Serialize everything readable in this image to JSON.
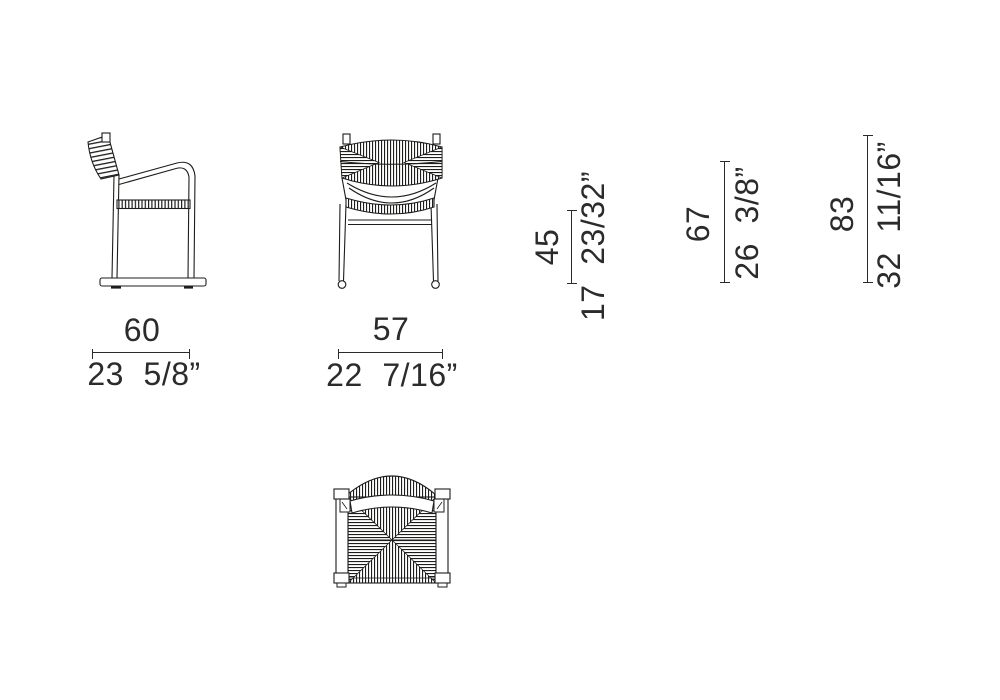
{
  "colors": {
    "line": "#1d1d1b",
    "background": "#ffffff",
    "text": "#2b2b2b"
  },
  "dimensions": {
    "side_width": {
      "cm": "60",
      "inches": "23 5/8”"
    },
    "front_width": {
      "cm": "57",
      "inches": "22 7/16”"
    },
    "seat_height": {
      "cm": "45",
      "inches": "17 23/32”"
    },
    "arm_height": {
      "cm": "67",
      "inches": "26 3/8”"
    },
    "overall_height": {
      "cm": "83",
      "inches": "32 11/16”"
    }
  }
}
